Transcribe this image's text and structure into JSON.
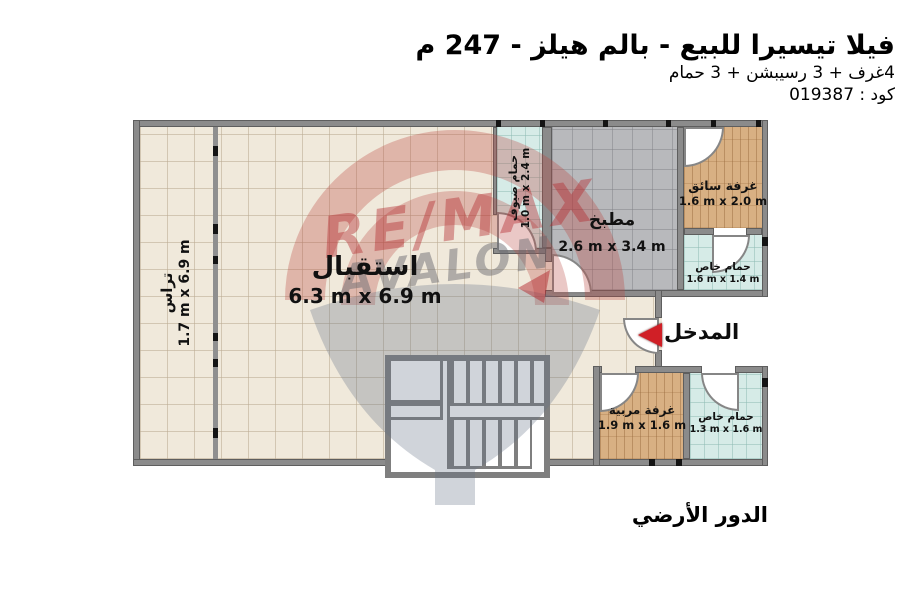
{
  "header": {
    "title": "فيلا تيسيرا للبيع - بالم هيلز - 247 م",
    "subtitle": "4غرف + 3 رسيبشن + 3 حمام",
    "code": "كود : 019387"
  },
  "plan": {
    "floor_label": "الدور الأرضي",
    "entrance_label": "المدخل",
    "rooms": {
      "terrace": {
        "name": "تراس",
        "dims": "1.7 m x 6.9 m"
      },
      "reception": {
        "name": "استقبال",
        "dims": "6.3 m x 6.9 m"
      },
      "guest_bath": {
        "name": "حمام ضيوف",
        "dims": "1.0 m x 2.4 m"
      },
      "kitchen": {
        "name": "مطبخ",
        "dims": "2.6 m x 3.4 m"
      },
      "driver_room": {
        "name": "غرفة سائق",
        "dims": "1.6 m x 2.0 m"
      },
      "driver_bath": {
        "name": "حمام خاص",
        "dims": "1.6 m x 1.4 m"
      },
      "nanny_room": {
        "name": "غرفة مربية",
        "dims": "1.9 m x 1.6 m"
      },
      "nanny_bath": {
        "name": "حمام خاص",
        "dims": "1.3 m x 1.6 m"
      }
    }
  },
  "watermark": {
    "brand": "RE/MAX",
    "office": "AVALON"
  },
  "colors": {
    "brand_red": "#c1272d",
    "arrow_red": "#d01f26",
    "wall_gray": "#8b8b8b",
    "floor_beige": "#f0e9db",
    "floor_kitchen_gray": "#b8b9bc",
    "floor_bath_cyan": "#d6ebe7",
    "floor_wood": "#d8b083",
    "text_black": "#111111"
  }
}
